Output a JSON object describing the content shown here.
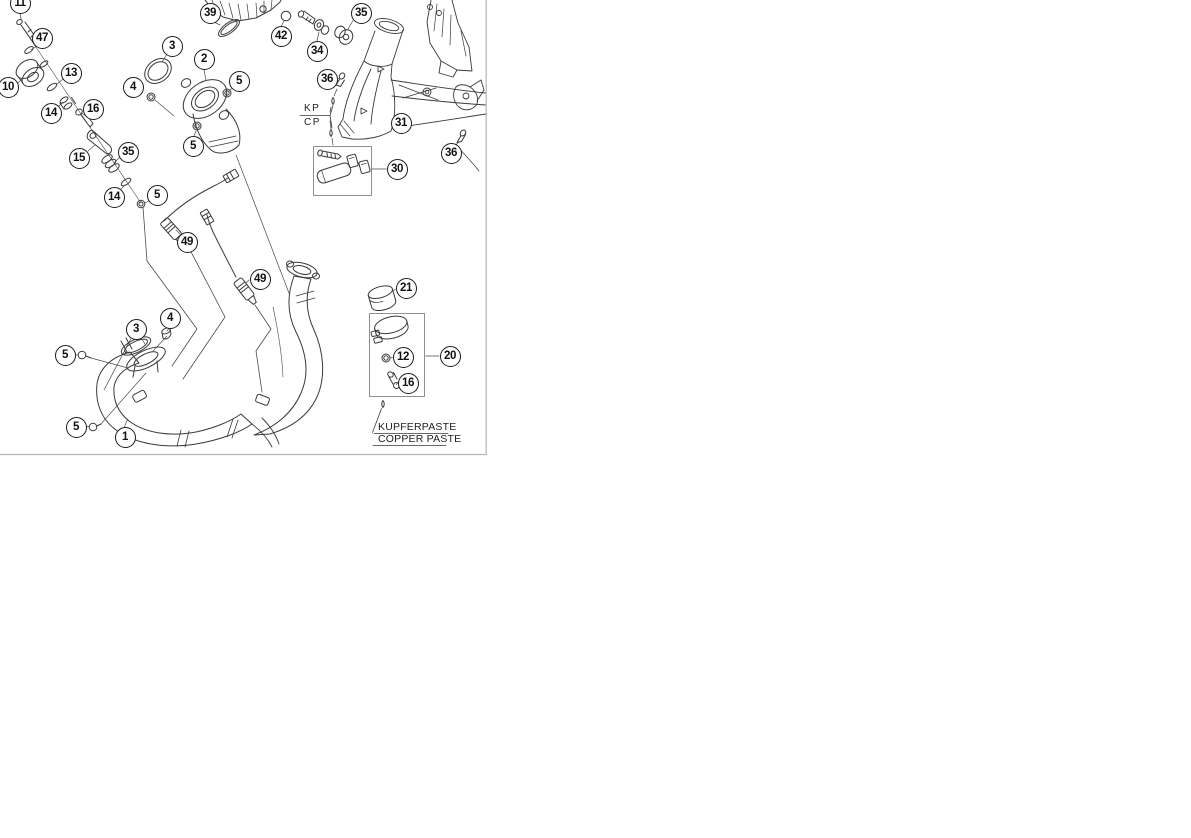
{
  "diagram": {
    "title": "exhaust-system-exploded-parts-diagram",
    "border_color": "#b5b5b5",
    "line_color": "#3a3a3a",
    "labels": {
      "kp": "KP",
      "cp": "CP",
      "kupferpaste": "KUPFERPASTE",
      "copper_paste": "COPPER PASTE"
    },
    "callouts": [
      {
        "n": "11",
        "x": 20,
        "y": 3
      },
      {
        "n": "47",
        "x": 42,
        "y": 38
      },
      {
        "n": "10",
        "x": 8,
        "y": 87
      },
      {
        "n": "13",
        "x": 71,
        "y": 73
      },
      {
        "n": "14",
        "x": 51,
        "y": 113
      },
      {
        "n": "16",
        "x": 93,
        "y": 109
      },
      {
        "n": "15",
        "x": 79,
        "y": 158
      },
      {
        "n": "35",
        "x": 128,
        "y": 152
      },
      {
        "n": "14",
        "x": 114,
        "y": 197
      },
      {
        "n": "5",
        "x": 157,
        "y": 195
      },
      {
        "n": "3",
        "x": 172,
        "y": 46
      },
      {
        "n": "2",
        "x": 204,
        "y": 59
      },
      {
        "n": "5",
        "x": 239,
        "y": 81
      },
      {
        "n": "4",
        "x": 133,
        "y": 87
      },
      {
        "n": "5",
        "x": 193,
        "y": 146
      },
      {
        "n": "39",
        "x": 210,
        "y": 13
      },
      {
        "n": "42",
        "x": 281,
        "y": 36
      },
      {
        "n": "34",
        "x": 317,
        "y": 51
      },
      {
        "n": "35",
        "x": 361,
        "y": 13
      },
      {
        "n": "36",
        "x": 327,
        "y": 79
      },
      {
        "n": "31",
        "x": 401,
        "y": 123
      },
      {
        "n": "36",
        "x": 451,
        "y": 153
      },
      {
        "n": "30",
        "x": 397,
        "y": 169
      },
      {
        "n": "49",
        "x": 187,
        "y": 242
      },
      {
        "n": "49",
        "x": 260,
        "y": 279
      },
      {
        "n": "21",
        "x": 406,
        "y": 288
      },
      {
        "n": "12",
        "x": 403,
        "y": 357
      },
      {
        "n": "16",
        "x": 408,
        "y": 383
      },
      {
        "n": "20",
        "x": 450,
        "y": 356
      },
      {
        "n": "3",
        "x": 136,
        "y": 329
      },
      {
        "n": "4",
        "x": 170,
        "y": 318
      },
      {
        "n": "5",
        "x": 65,
        "y": 355
      },
      {
        "n": "5",
        "x": 76,
        "y": 427
      },
      {
        "n": "1",
        "x": 125,
        "y": 437
      }
    ]
  }
}
